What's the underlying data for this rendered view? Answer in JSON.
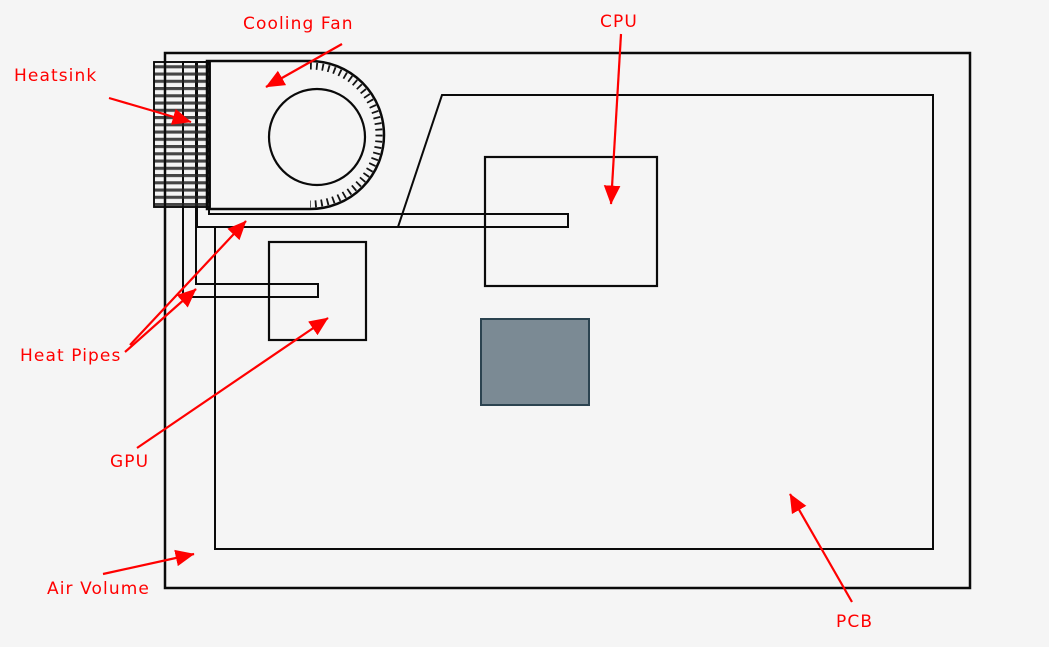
{
  "diagram": {
    "labels": {
      "heatsink": "Heatsink",
      "cooling_fan": "Cooling Fan",
      "cpu": "CPU",
      "heat_pipes": "Heat Pipes",
      "gpu": "GPU",
      "air_volume": "Air Volume",
      "pcb": "PCB"
    },
    "colors": {
      "annotation_red": "#ff0000",
      "background": "#f5f5f5",
      "air_volume_fill": "#c9c9c9",
      "pcb_fill": "#76858e",
      "pcb_cutout_fill": "#7b8a94",
      "cpu_fill": "#3d5e6e",
      "gpu_fill": "#7a7050",
      "fan_fill": "#6b92b0",
      "fan_hub_fill": "#7e8d98",
      "heatsink_base_fill": "#c2c2c2",
      "heat_pipe_cpu_fill": "rgba(170,95,85,0.55)",
      "heat_pipe_gpu_fill": "rgba(130,110,15,0.55)",
      "outline": "#0a0a0a"
    }
  }
}
